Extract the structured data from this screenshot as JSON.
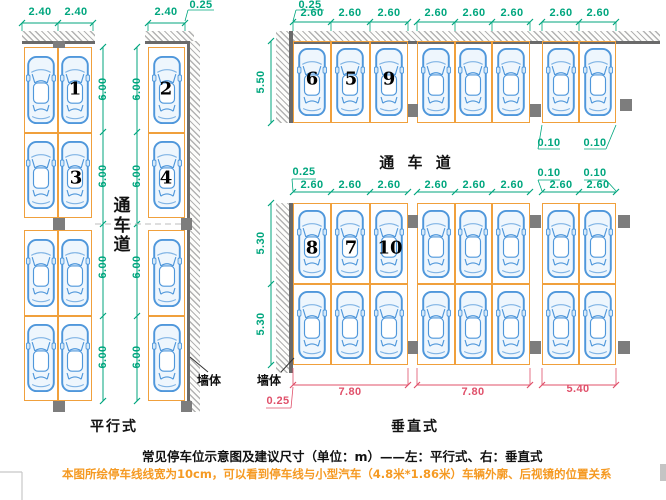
{
  "colors": {
    "dimension_green": "#00a67e",
    "dimension_red": "#e0506a",
    "stall_orange": "#f0a03c",
    "car_blue": "#4f97db",
    "note_orange": "#f59a23"
  },
  "left_layout": {
    "type_label": "平行式",
    "wall_label": "墙体",
    "lane_label_chars": [
      "通",
      "车",
      "道"
    ],
    "top_dims": [
      "2.40",
      "2.40",
      "2.40"
    ],
    "wall_thickness_dim": "0.25",
    "depth_dims_inner": [
      "6.00",
      "6.00",
      "6.00",
      "6.00"
    ],
    "depth_dims_outer": [
      "6.00",
      "6.00",
      "6.00",
      "6.00"
    ],
    "stall_numbers": [
      "1",
      "2",
      "3",
      "4"
    ]
  },
  "right_layout": {
    "type_label": "垂直式",
    "wall_label": "墙体",
    "lane_label": "通 车 道",
    "top_wall_thickness_dim": "0.25",
    "top_row_dims": [
      "2.60",
      "2.60",
      "2.60",
      "2.60",
      "2.60",
      "2.60",
      "2.60",
      "2.60"
    ],
    "top_line_width_dims": [
      "0.10",
      "0.10"
    ],
    "top_depth_dim": "5.50",
    "bottom_wall_thickness_dim": "0.25",
    "bottom_row_dims": [
      "2.60",
      "2.60",
      "2.60",
      "2.60",
      "2.60",
      "2.60",
      "2.60",
      "2.60"
    ],
    "bottom_line_width_dims": [
      "0.10",
      "0.10"
    ],
    "bottom_depth_dims": [
      "5.30",
      "5.30"
    ],
    "bottom_total_dims": [
      "7.80",
      "7.80",
      "5.40"
    ],
    "bottom_red_wall_dim": "0.25",
    "stall_numbers_top": [
      "6",
      "5",
      "9"
    ],
    "stall_numbers_bottom": [
      "8",
      "7",
      "10"
    ]
  },
  "captions": {
    "title": "常见停车位示意图及建议尺寸（单位：m）——左：平行式、右：垂直式",
    "note": "本图所绘停车线线宽为10cm，可以看到停车线与小型汽车（4.8米*1.86米）车辆外廓、后视镜的位置关系"
  }
}
